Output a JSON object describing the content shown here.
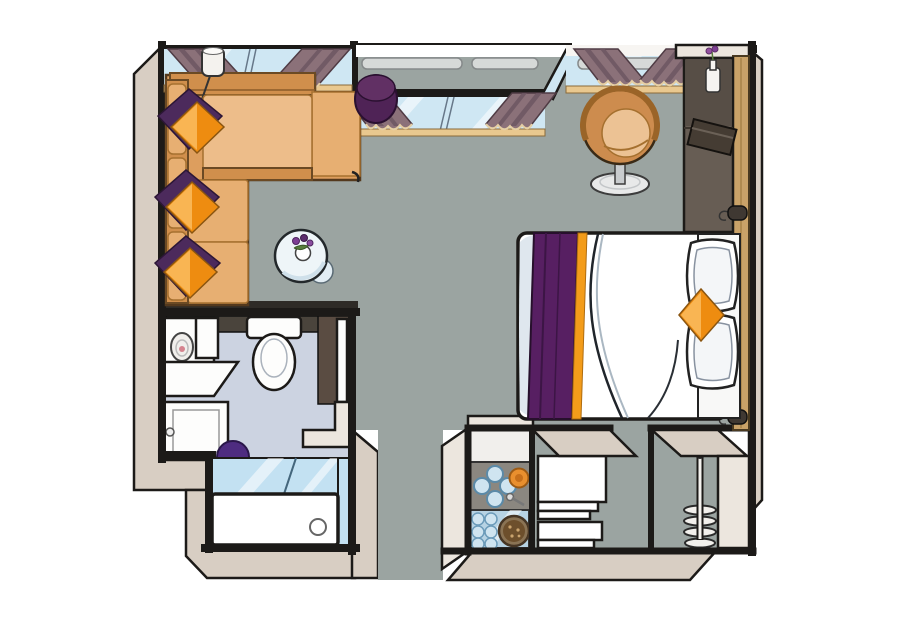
{
  "title": "Cabin suite floor plan illustration (top-down pseudo-3D view)",
  "colors": {
    "outline": "#1c1a18",
    "wallBand": "#d8cec3",
    "wallBandLight": "#ece6de",
    "floor": "#9ba4a1",
    "floorBath": "#ccd3e1",
    "nicheFloor": "#f1efec",
    "glass": "#cfe7f3",
    "sill": "#e9c88f",
    "railing": "#d6d9d8",
    "curtain": "#8b7179",
    "curtainDark": "#6c5662",
    "curtainTrim": "#e6cfa4",
    "sofaBase": "#dd9e5e",
    "sofaDark": "#d08f4c",
    "sofaLight": "#edbd8a",
    "sofaMid": "#e7af72",
    "wood": "#cd9a55",
    "pillowOrange1": "#f9b553",
    "pillowOrange2": "#ee8c10",
    "pillowPurple": "#4c2a5c",
    "bedWhite": "#ffffff",
    "bedShade": "#dfe7ee",
    "runner": "#571f62",
    "runnerStripe": "#f39c1a",
    "chairBody": "#cd8c4e",
    "chairCushion": "#ecc294",
    "chairBase": "#e8e9e9",
    "wardrobe": "#675d54",
    "wardrobeDark": "#574e46",
    "woodWall": "#c9a268",
    "tv": "#453c33",
    "ottoman": "#4f2356",
    "stool": "#4e2c80",
    "tubGlass": "#c3e1f2",
    "trayGray": "#8b8780",
    "trayBlue": "#b7d3e4",
    "glassCup": "#cfe4f0",
    "plate": "#8a7354",
    "plateDark": "#6d4f2c",
    "orangeItem": "#e98f2e",
    "white": "#ffffff",
    "toiletWhite": "#fdfdfc",
    "darkFace": "#4a443c",
    "brownFace": "#5a4c42",
    "shadow": "#2e2b27"
  },
  "rooms": [
    {
      "name": "lounge",
      "items": [
        "L-shaped sofa",
        "3 orange diamond pillows on purple throws",
        "corner wood console",
        "floor lamp",
        "round side table with flowers and saucer",
        "window with two curtains"
      ]
    },
    {
      "name": "french-balcony",
      "items": [
        "railing",
        "sliding glass door",
        "two curtains",
        "purple ottoman"
      ]
    },
    {
      "name": "bedroom",
      "items": [
        "double bed with white duvet",
        "purple bed runner with orange stripe",
        "two white pillows",
        "orange diamond cushion",
        "tub chair on pedestal",
        "wardrobe with TV and flower vase",
        "wood wall panel with two handles",
        "window with two curtains"
      ]
    },
    {
      "name": "bathroom",
      "items": [
        "toilet",
        "washbasin unit",
        "counter shelf",
        "storage cabinet",
        "purple stool",
        "bathtub with glass screen",
        "door"
      ]
    },
    {
      "name": "entry-area",
      "items": [
        "minibar niche with glass tray",
        "welcome tray with glasses and plate",
        "two white luggage stools",
        "corridor",
        "coat stand with spiral hooks"
      ]
    }
  ]
}
